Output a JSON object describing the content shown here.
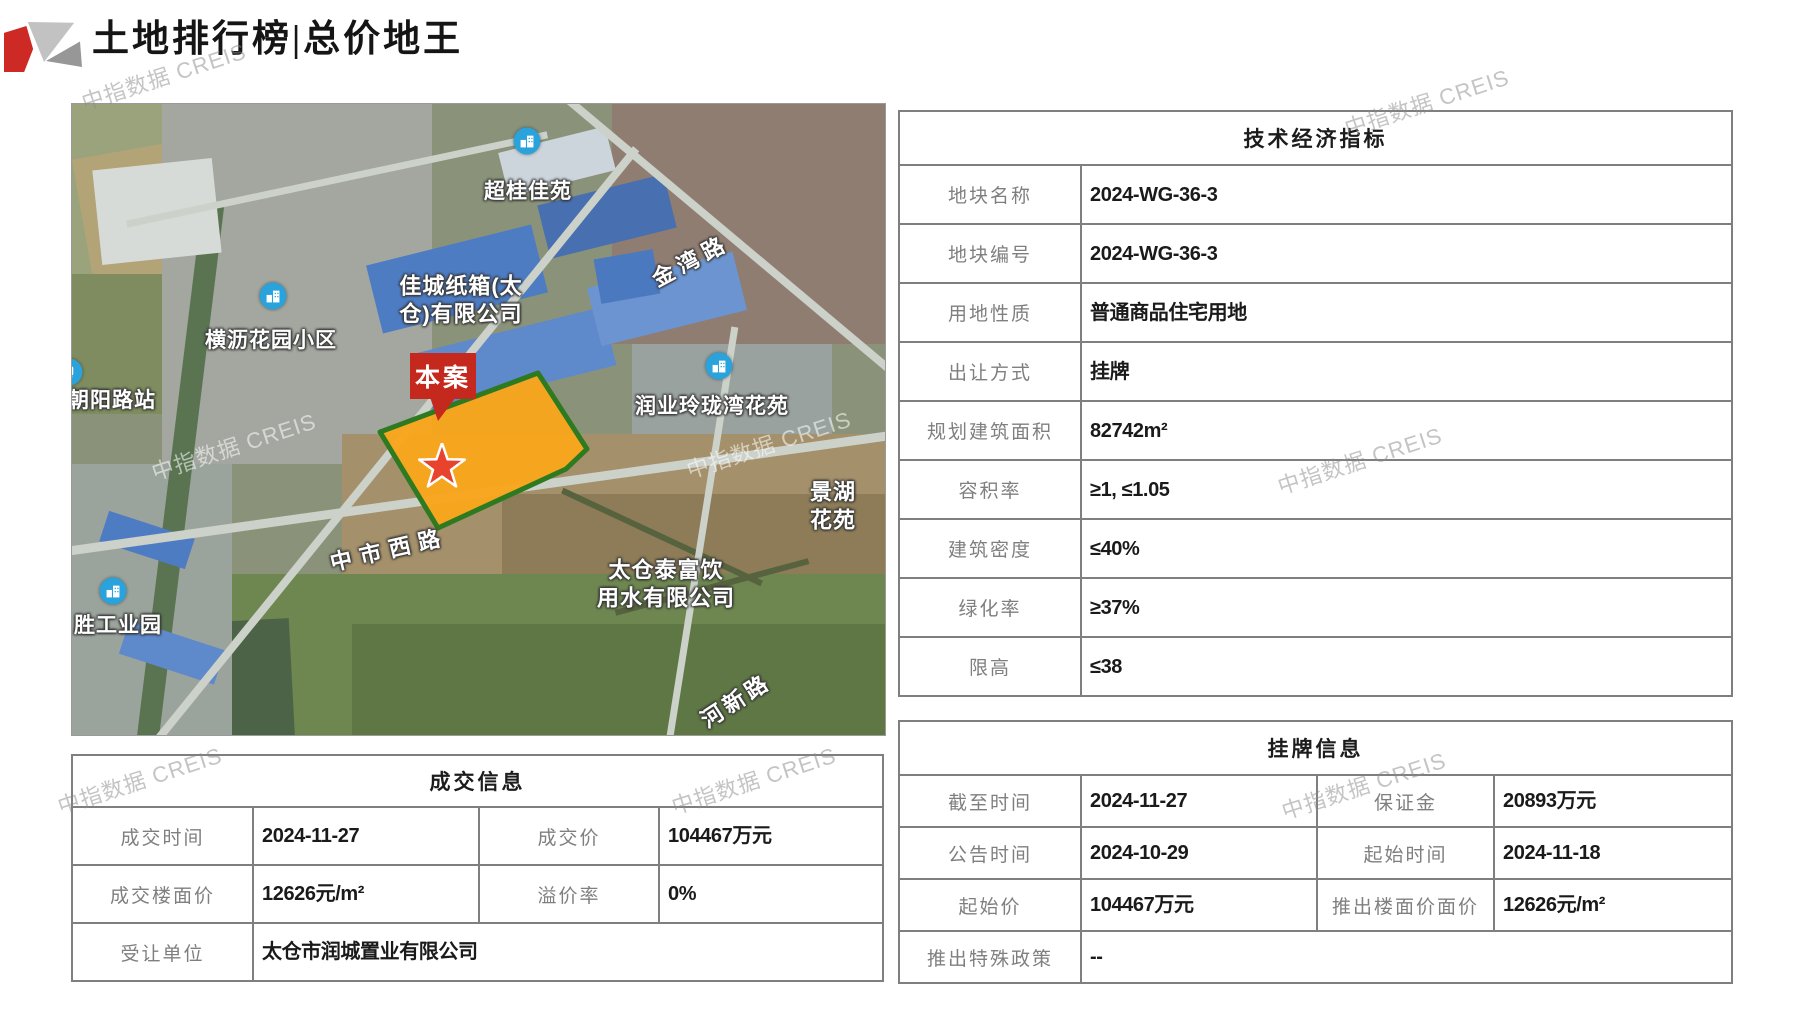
{
  "header": {
    "title": "土地排行榜|总价地王"
  },
  "watermark": {
    "text": "中指数据 CREIS"
  },
  "map": {
    "marker_label": "本案",
    "pois": [
      {
        "label": "超桂佳苑"
      },
      {
        "label": "横沥花园小区"
      },
      {
        "label": "润业玲珑湾花苑"
      },
      {
        "label": "朝阳路站"
      },
      {
        "label": "胜工业园"
      }
    ],
    "area_labels": [
      {
        "label": "佳城纸箱(太\n仓)有限公司"
      },
      {
        "label": "景湖花苑"
      },
      {
        "label": "太仓泰富饮\n用水有限公司"
      }
    ],
    "road_labels": [
      {
        "label": "金湾路"
      },
      {
        "label": "中市西路"
      },
      {
        "label": "河新路"
      }
    ]
  },
  "deal_table": {
    "title": "成交信息",
    "row1": {
      "l1": "成交时间",
      "v1": "2024-11-27",
      "l2": "成交价",
      "v2": "104467万元"
    },
    "row2": {
      "l1": "成交楼面价",
      "v1": "12626元/m²",
      "l2": "溢价率",
      "v2": "0%"
    },
    "row3": {
      "l1": "受让单位",
      "v1": "太仓市润城置业有限公司"
    }
  },
  "tech_table": {
    "title": "技术经济指标",
    "rows": [
      {
        "label": "地块名称",
        "value": "2024-WG-36-3"
      },
      {
        "label": "地块编号",
        "value": "2024-WG-36-3"
      },
      {
        "label": "用地性质",
        "value": "普通商品住宅用地"
      },
      {
        "label": "出让方式",
        "value": "挂牌"
      },
      {
        "label": "规划建筑面积",
        "value": "82742m²"
      },
      {
        "label": "容积率",
        "value": "≥1, ≤1.05"
      },
      {
        "label": "建筑密度",
        "value": "≤40%"
      },
      {
        "label": "绿化率",
        "value": "≥37%"
      },
      {
        "label": "限高",
        "value": "≤38"
      }
    ]
  },
  "listing_table": {
    "title": "挂牌信息",
    "row1": {
      "l1": "截至时间",
      "v1": "2024-11-27",
      "l2": "保证金",
      "v2": "20893万元"
    },
    "row2": {
      "l1": "公告时间",
      "v1": "2024-10-29",
      "l2": "起始时间",
      "v2": "2024-11-18"
    },
    "row3": {
      "l1": "起始价",
      "v1": "104467万元",
      "l2": "推出楼面价面价",
      "v2": "12626元/m²"
    },
    "row4": {
      "l1": "推出特殊政策",
      "v1": "--"
    }
  }
}
